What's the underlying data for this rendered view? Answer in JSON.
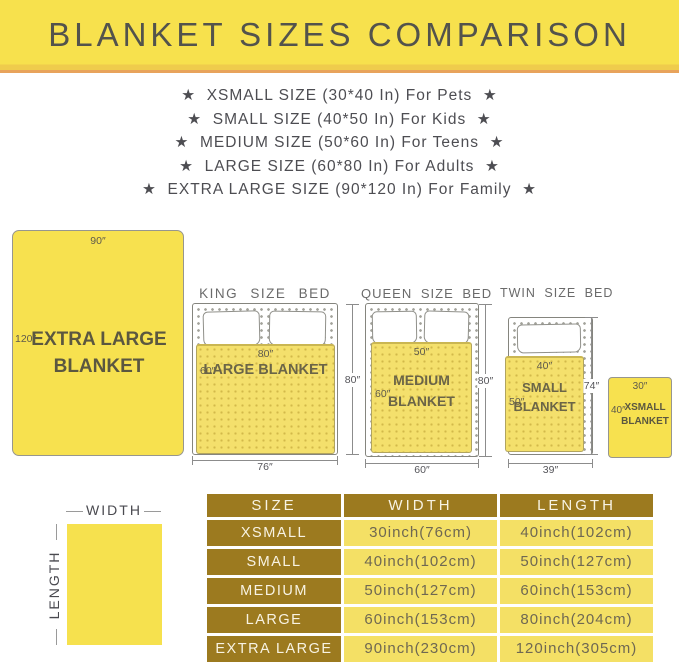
{
  "colors": {
    "banner_yellow": "#F7E14D",
    "accent_orange": "#E8A35C",
    "blanket_yellow": "#F7E14F",
    "bed_blanket_yellow": "#F4E06C",
    "table_header_bg": "#9C7A1F",
    "table_cell_bg": "#F4E065",
    "title_text": "#53534C"
  },
  "header": {
    "title": "BLANKET SIZES COMPARISON"
  },
  "size_list": [
    "★  XSMALL SIZE (30*40 In) For Pets  ★",
    "★  SMALL SIZE (40*50 In) For Kids  ★",
    "★  MEDIUM SIZE (50*60 In) For Teens  ★",
    "★  LARGE SIZE (60*80 In) For Adults  ★",
    "★  EXTRA LARGE SIZE (90*120 In) For Family  ★"
  ],
  "diagram": {
    "xl": {
      "top_dim": "90″",
      "left_dim": "120″",
      "name": "EXTRA LARGE BLANKET"
    },
    "king": {
      "title": "KING SIZE BED",
      "blanket_name": "LARGE BLANKET",
      "blanket_top_dim": "80″",
      "blanket_side_dim": "60″",
      "bed_side_dim": "80″",
      "bed_bottom_dim": "76″"
    },
    "queen": {
      "title": "QUEEN SIZE BED",
      "blanket_name": "MEDIUM BLANKET",
      "blanket_top_dim": "50″",
      "blanket_side_dim": "60″",
      "bed_side_dim": "80″",
      "bed_bottom_dim": "60″"
    },
    "twin": {
      "title": "TWIN SIZE BED",
      "blanket_name": "SMALL BLANKET",
      "blanket_top_dim": "40″",
      "blanket_side_dim": "50″",
      "bed_side_dim": "74″",
      "bed_bottom_dim": "39″"
    },
    "xsmall": {
      "top_dim": "30″",
      "left_dim": "40″",
      "name": "XSMALL BLANKET"
    },
    "axes": {
      "width": "WIDTH",
      "length": "LENGTH"
    }
  },
  "table": {
    "headers": [
      "SIZE",
      "WIDTH",
      "LENGTH"
    ],
    "rows": [
      {
        "size": "XSMALL",
        "width": "30inch(76cm)",
        "length": "40inch(102cm)"
      },
      {
        "size": "SMALL",
        "width": "40inch(102cm)",
        "length": "50inch(127cm)"
      },
      {
        "size": "MEDIUM",
        "width": "50inch(127cm)",
        "length": "60inch(153cm)"
      },
      {
        "size": "LARGE",
        "width": "60inch(153cm)",
        "length": "80inch(204cm)"
      },
      {
        "size": "EXTRA LARGE",
        "width": "90inch(230cm)",
        "length": "120inch(305cm)"
      }
    ]
  }
}
